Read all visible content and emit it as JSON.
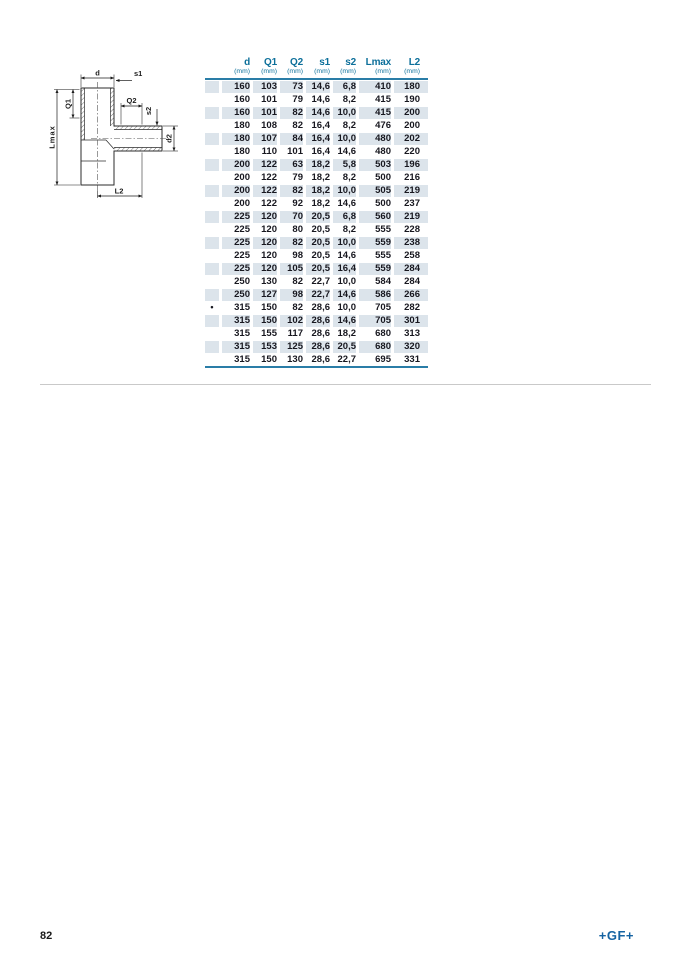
{
  "page": {
    "number": "82",
    "logo": "+GF+"
  },
  "colors": {
    "table_rule": "#2a7da7",
    "header_text": "#0c6f9a",
    "row_stripe": "#dce4eb",
    "data_text": "#17171f",
    "logo_blue": "#1563a2",
    "divider_gray": "#c9c9c9"
  },
  "diagram": {
    "description": "dimensioned section drawing of a reducing tee pipe fitting",
    "labels": {
      "d": "d",
      "s1": "s1",
      "q1": "Q1",
      "lmax": "Lmax",
      "q2": "Q2",
      "s2": "s2",
      "d2": "d2",
      "l2": "L2"
    }
  },
  "table": {
    "columns": [
      {
        "label": "d",
        "unit": "(mm)"
      },
      {
        "label": "Q1",
        "unit": "(mm)"
      },
      {
        "label": "Q2",
        "unit": "(mm)"
      },
      {
        "label": "s1",
        "unit": "(mm)"
      },
      {
        "label": "s2",
        "unit": "(mm)"
      },
      {
        "label": "Lmax",
        "unit": "(mm)"
      },
      {
        "label": "L2",
        "unit": "(mm)"
      }
    ],
    "rows": [
      {
        "marker": "",
        "values": [
          "160",
          "103",
          "73",
          "14,6",
          "6,8",
          "410",
          "180"
        ]
      },
      {
        "marker": "",
        "values": [
          "160",
          "101",
          "79",
          "14,6",
          "8,2",
          "415",
          "190"
        ]
      },
      {
        "marker": "",
        "values": [
          "160",
          "101",
          "82",
          "14,6",
          "10,0",
          "415",
          "200"
        ]
      },
      {
        "marker": "",
        "values": [
          "180",
          "108",
          "82",
          "16,4",
          "8,2",
          "476",
          "200"
        ]
      },
      {
        "marker": "",
        "values": [
          "180",
          "107",
          "84",
          "16,4",
          "10,0",
          "480",
          "202"
        ]
      },
      {
        "marker": "",
        "values": [
          "180",
          "110",
          "101",
          "16,4",
          "14,6",
          "480",
          "220"
        ]
      },
      {
        "marker": "",
        "values": [
          "200",
          "122",
          "63",
          "18,2",
          "5,8",
          "503",
          "196"
        ]
      },
      {
        "marker": "",
        "values": [
          "200",
          "122",
          "79",
          "18,2",
          "8,2",
          "500",
          "216"
        ]
      },
      {
        "marker": "",
        "values": [
          "200",
          "122",
          "82",
          "18,2",
          "10,0",
          "505",
          "219"
        ]
      },
      {
        "marker": "",
        "values": [
          "200",
          "122",
          "92",
          "18,2",
          "14,6",
          "500",
          "237"
        ]
      },
      {
        "marker": "",
        "values": [
          "225",
          "120",
          "70",
          "20,5",
          "6,8",
          "560",
          "219"
        ]
      },
      {
        "marker": "",
        "values": [
          "225",
          "120",
          "80",
          "20,5",
          "8,2",
          "555",
          "228"
        ]
      },
      {
        "marker": "",
        "values": [
          "225",
          "120",
          "82",
          "20,5",
          "10,0",
          "559",
          "238"
        ]
      },
      {
        "marker": "",
        "values": [
          "225",
          "120",
          "98",
          "20,5",
          "14,6",
          "555",
          "258"
        ]
      },
      {
        "marker": "",
        "values": [
          "225",
          "120",
          "105",
          "20,5",
          "16,4",
          "559",
          "284"
        ]
      },
      {
        "marker": "",
        "values": [
          "250",
          "130",
          "82",
          "22,7",
          "10,0",
          "584",
          "284"
        ]
      },
      {
        "marker": "",
        "values": [
          "250",
          "127",
          "98",
          "22,7",
          "14,6",
          "586",
          "266"
        ]
      },
      {
        "marker": "•",
        "values": [
          "315",
          "150",
          "82",
          "28,6",
          "10,0",
          "705",
          "282"
        ]
      },
      {
        "marker": "",
        "values": [
          "315",
          "150",
          "102",
          "28,6",
          "14,6",
          "705",
          "301"
        ]
      },
      {
        "marker": "",
        "values": [
          "315",
          "155",
          "117",
          "28,6",
          "18,2",
          "680",
          "313"
        ]
      },
      {
        "marker": "",
        "values": [
          "315",
          "153",
          "125",
          "28,6",
          "20,5",
          "680",
          "320"
        ]
      },
      {
        "marker": "",
        "values": [
          "315",
          "150",
          "130",
          "28,6",
          "22,7",
          "695",
          "331"
        ]
      }
    ]
  }
}
